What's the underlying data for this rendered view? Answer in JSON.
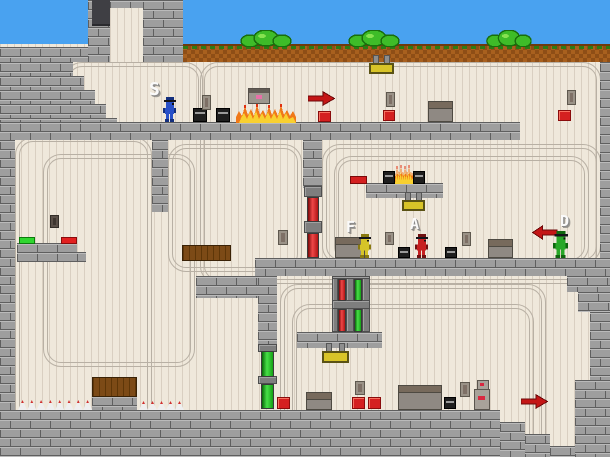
{
  "scene": {
    "width": 610,
    "height": 457,
    "colors": {
      "sky": "#49A2F0",
      "wall": "#EFE8DB",
      "wall_stripe": "#D9CFC1",
      "brick": "#9E9E9E",
      "brick_mortar": "#5F5F5F",
      "dirt": "#A8601E",
      "bush": "#3EBC28",
      "accent_red": "#D42020",
      "accent_green": "#2FD62F",
      "accent_yellow": "#D8C428",
      "arrow_red": "#C41616",
      "fire_orange": "#F07818",
      "fire_yellow": "#F8D030"
    },
    "players": [
      {
        "id": "s",
        "label": "S",
        "color": "#2850C8",
        "dark": "#14307E",
        "x": 162,
        "y": 97,
        "w": 15,
        "h": 25,
        "lx": 149,
        "ly": 81,
        "lsize": 18
      },
      {
        "id": "f",
        "label": "F",
        "color": "#D6C428",
        "dark": "#8A7A10",
        "x": 357,
        "y": 234,
        "w": 15,
        "h": 24,
        "lx": 346,
        "ly": 220,
        "lsize": 15
      },
      {
        "id": "a",
        "label": "A",
        "color": "#C62020",
        "dark": "#701010",
        "x": 414,
        "y": 234,
        "w": 15,
        "h": 24,
        "lx": 410,
        "ly": 217,
        "lsize": 15
      },
      {
        "id": "d",
        "label": "D",
        "color": "#28A828",
        "dark": "#0E660E",
        "x": 552,
        "y": 231,
        "w": 17,
        "h": 27,
        "lx": 560,
        "ly": 214,
        "lsize": 15
      }
    ],
    "terrain": {
      "sky": [
        0,
        0,
        610,
        62
      ],
      "wall": [
        0,
        44,
        610,
        413
      ],
      "chimney_inner": [
        110,
        8,
        33,
        54
      ],
      "dirt": [
        183,
        44,
        427,
        18
      ],
      "doorway": [
        92,
        0,
        18,
        26
      ],
      "tubes": [
        [
          68,
          66,
          131,
          70
        ],
        [
          204,
          66,
          393,
          214
        ],
        [
          19,
          141,
          129,
          320
        ],
        [
          47,
          158,
          144,
          205
        ],
        [
          172,
          148,
          126,
          120
        ],
        [
          326,
          148,
          271,
          112
        ],
        [
          338,
          160,
          247,
          100
        ],
        [
          284,
          288,
          258,
          170
        ],
        [
          296,
          308,
          234,
          150
        ]
      ],
      "bricks": [
        [
          0,
          47,
          88,
          15
        ],
        [
          88,
          0,
          22,
          62
        ],
        [
          110,
          0,
          33,
          8
        ],
        [
          143,
          0,
          40,
          62
        ],
        [
          0,
          62,
          73,
          14
        ],
        [
          0,
          76,
          84,
          14
        ],
        [
          0,
          90,
          95,
          14
        ],
        [
          0,
          104,
          106,
          14
        ],
        [
          0,
          118,
          117,
          22
        ],
        [
          0,
          122,
          520,
          18
        ],
        [
          0,
          140,
          15,
          317
        ],
        [
          152,
          140,
          16,
          72
        ],
        [
          303,
          140,
          19,
          48
        ],
        [
          366,
          183,
          77,
          15
        ],
        [
          255,
          258,
          355,
          18
        ],
        [
          196,
          276,
          62,
          22
        ],
        [
          258,
          276,
          19,
          70
        ],
        [
          297,
          332,
          85,
          16
        ],
        [
          600,
          62,
          10,
          196
        ],
        [
          567,
          276,
          43,
          16
        ],
        [
          578,
          292,
          32,
          20
        ],
        [
          590,
          312,
          20,
          68
        ],
        [
          575,
          380,
          35,
          77
        ],
        [
          0,
          410,
          500,
          47
        ],
        [
          500,
          422,
          25,
          35
        ],
        [
          525,
          434,
          25,
          23
        ],
        [
          550,
          446,
          25,
          11
        ],
        [
          92,
          396,
          45,
          14
        ],
        [
          17,
          243,
          60,
          10
        ],
        [
          17,
          252,
          69,
          10
        ]
      ]
    },
    "entities": {
      "bushes": [
        [
          240,
          30,
          52,
          17
        ],
        [
          348,
          30,
          52,
          17
        ],
        [
          486,
          30,
          46,
          17
        ]
      ],
      "fires": [
        [
          236,
          103,
          60,
          20
        ],
        [
          394,
          164,
          20,
          20
        ]
      ],
      "crates": [
        [
          428,
          101,
          25,
          21
        ],
        [
          335,
          237,
          30,
          21
        ],
        [
          488,
          239,
          25,
          19
        ],
        [
          398,
          385,
          44,
          25
        ],
        [
          306,
          392,
          26,
          18
        ]
      ],
      "black_boxes": [
        [
          193,
          108,
          14,
          14
        ],
        [
          216,
          108,
          14,
          14
        ],
        [
          383,
          171,
          12,
          13
        ],
        [
          413,
          171,
          12,
          13
        ],
        [
          398,
          247,
          12,
          11
        ],
        [
          445,
          247,
          12,
          11
        ],
        [
          444,
          397,
          12,
          12
        ]
      ],
      "red_buttons": [
        [
          318,
          111,
          13,
          11
        ],
        [
          383,
          110,
          12,
          11
        ],
        [
          558,
          110,
          13,
          11
        ],
        [
          277,
          397,
          13,
          12
        ],
        [
          352,
          397,
          13,
          12
        ],
        [
          368,
          397,
          13,
          12
        ]
      ],
      "pressure_plates": [
        {
          "x": 19,
          "y": 237,
          "w": 16,
          "h": 7,
          "color": "green"
        },
        {
          "x": 61,
          "y": 237,
          "w": 16,
          "h": 7,
          "color": "red"
        }
      ],
      "red_bar": [
        350,
        176,
        17,
        8
      ],
      "vents": [
        [
          202,
          95,
          9,
          15,
          0
        ],
        [
          386,
          92,
          9,
          15,
          0
        ],
        [
          567,
          90,
          9,
          15,
          0
        ],
        [
          50,
          215,
          9,
          13,
          1
        ],
        [
          278,
          230,
          10,
          15,
          0
        ],
        [
          385,
          232,
          9,
          13,
          0
        ],
        [
          462,
          232,
          9,
          14,
          0
        ],
        [
          355,
          381,
          10,
          14,
          0
        ],
        [
          460,
          382,
          10,
          15,
          0
        ]
      ],
      "machines": [
        [
          248,
          88,
          22,
          16
        ]
      ],
      "devices": [
        [
          474,
          380,
          16,
          30
        ]
      ],
      "signs": [
        [
          369,
          55,
          25,
          19
        ],
        [
          402,
          192,
          23,
          19
        ],
        [
          322,
          343,
          27,
          20
        ]
      ],
      "arrows": [
        {
          "x": 308,
          "y": 91,
          "w": 27,
          "h": 15,
          "dir": "right"
        },
        {
          "x": 521,
          "y": 394,
          "w": 27,
          "h": 15,
          "dir": "right"
        },
        {
          "x": 532,
          "y": 225,
          "w": 26,
          "h": 15,
          "dir": "left"
        }
      ],
      "wood": [
        [
          182,
          245,
          49,
          16
        ],
        [
          92,
          377,
          45,
          20
        ]
      ],
      "spike_groups": [
        {
          "x": 18,
          "y": 400,
          "h": 10,
          "count": 8,
          "pitch": 9.3
        },
        {
          "x": 139,
          "y": 401,
          "h": 9,
          "count": 5,
          "pitch": 9
        }
      ],
      "door_frames": [
        [
          304,
          186,
          18,
          11
        ],
        [
          304,
          221,
          18,
          12
        ],
        [
          332,
          276,
          6,
          56
        ],
        [
          346,
          276,
          8,
          56
        ],
        [
          362,
          276,
          8,
          56
        ],
        [
          332,
          276,
          38,
          3
        ],
        [
          332,
          300,
          38,
          9
        ],
        [
          258,
          344,
          19,
          8
        ],
        [
          258,
          376,
          19,
          8
        ]
      ],
      "door_bars": [
        {
          "x": 307,
          "y": 197,
          "w": 12,
          "h": 25,
          "color": "red"
        },
        {
          "x": 307,
          "y": 233,
          "w": 12,
          "h": 25,
          "color": "red"
        },
        {
          "x": 338,
          "y": 279,
          "w": 8,
          "h": 22,
          "color": "red"
        },
        {
          "x": 338,
          "y": 309,
          "w": 8,
          "h": 23,
          "color": "red"
        },
        {
          "x": 354,
          "y": 279,
          "w": 8,
          "h": 22,
          "color": "green"
        },
        {
          "x": 354,
          "y": 309,
          "w": 8,
          "h": 23,
          "color": "green"
        },
        {
          "x": 261,
          "y": 351,
          "w": 13,
          "h": 26,
          "color": "green"
        },
        {
          "x": 261,
          "y": 384,
          "w": 13,
          "h": 25,
          "color": "green"
        }
      ]
    }
  }
}
